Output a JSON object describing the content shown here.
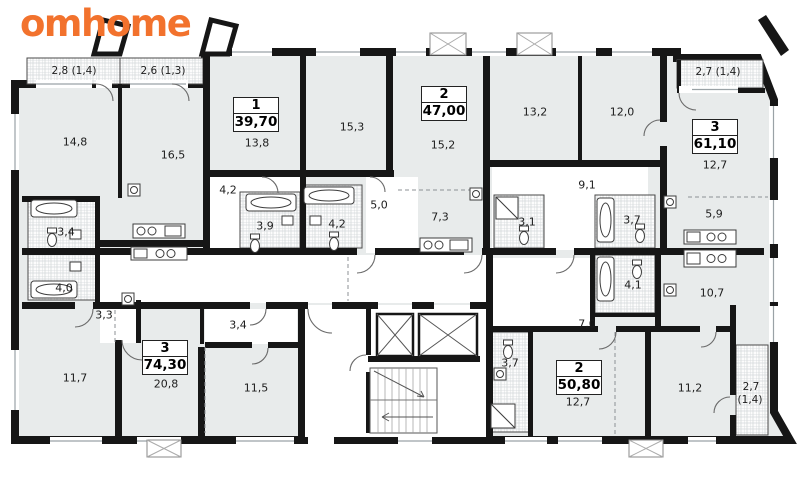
{
  "logo": {
    "text": "omhome"
  },
  "colors": {
    "accent": "#F2722D",
    "wall": "#161616",
    "room_fill": "#E8EBEB"
  },
  "apartments": [
    {
      "rooms": "1",
      "area": "39,70"
    },
    {
      "rooms": "2",
      "area": "47,00"
    },
    {
      "rooms": "3",
      "area": "61,10"
    },
    {
      "rooms": "3",
      "area": "74,30"
    },
    {
      "rooms": "2",
      "area": "50,80"
    }
  ],
  "balconies": [
    {
      "label": "2,8 (1,4)"
    },
    {
      "label": "2,6 (1,3)"
    },
    {
      "label": "2,7 (1,4)"
    },
    {
      "label": "2,7"
    },
    {
      "label": "(1,4)"
    }
  ],
  "rooms": [
    {
      "area": "14,8"
    },
    {
      "area": "16,5"
    },
    {
      "area": "13,8"
    },
    {
      "area": "15,3"
    },
    {
      "area": "15,2"
    },
    {
      "area": "13,2"
    },
    {
      "area": "12,0"
    },
    {
      "area": "12,7"
    },
    {
      "area": "9,1"
    },
    {
      "area": "4,2"
    },
    {
      "area": "3,9"
    },
    {
      "area": "4,2"
    },
    {
      "area": "5,0"
    },
    {
      "area": "7,3"
    },
    {
      "area": "3,1"
    },
    {
      "area": "3,7"
    },
    {
      "area": "5,9"
    },
    {
      "area": "3,4"
    },
    {
      "area": "4,0"
    },
    {
      "area": "3,3"
    },
    {
      "area": "11,7"
    },
    {
      "area": "20,8"
    },
    {
      "area": "3,4"
    },
    {
      "area": "11,5"
    },
    {
      "area": "7,0"
    },
    {
      "area": "4,1"
    },
    {
      "area": "10,7"
    },
    {
      "area": "3,7"
    },
    {
      "area": "12,7"
    },
    {
      "area": "11,2"
    }
  ]
}
